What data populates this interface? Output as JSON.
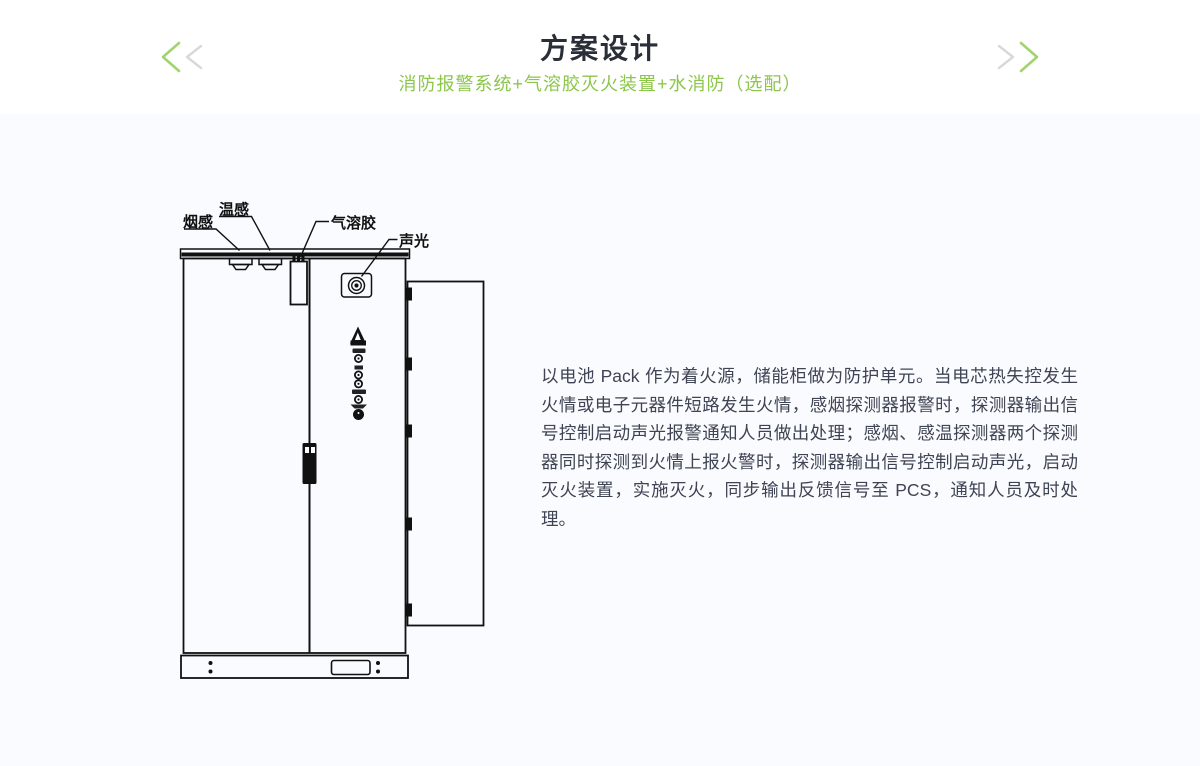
{
  "header": {
    "title": "方案设计",
    "subtitle": "消防报警系统+气溶胶灭火装置+水消防（选配）",
    "prev_icon": "double-chevron-left",
    "next_icon": "double-chevron-right"
  },
  "diagram": {
    "labels": {
      "smoke": "烟感",
      "temperature": "温感",
      "aerosol": "气溶胶",
      "sound_light": "声光"
    }
  },
  "description": "以电池 Pack 作为着火源，储能柜做为防护单元。当电芯热失控发生火情或电子元器件短路发生火情，感烟探测器报警时，探测器输出信号控制启动声光报警通知人员做出处理；感烟、感温探测器两个探测器同时探测到火情上报火警时，探测器输出信号控制启动声光，启动灭火装置，实施灭火，同步输出反馈信号至 PCS，通知人员及时处理。",
  "colors": {
    "accent_green": "#8CC64B",
    "arrow_green": "#A2D46E",
    "arrow_gray": "#D8D8D8",
    "title_text": "#2A2E37",
    "body_text": "#3E4453",
    "content_bg": "#FAFBFE",
    "line": "#111111"
  }
}
